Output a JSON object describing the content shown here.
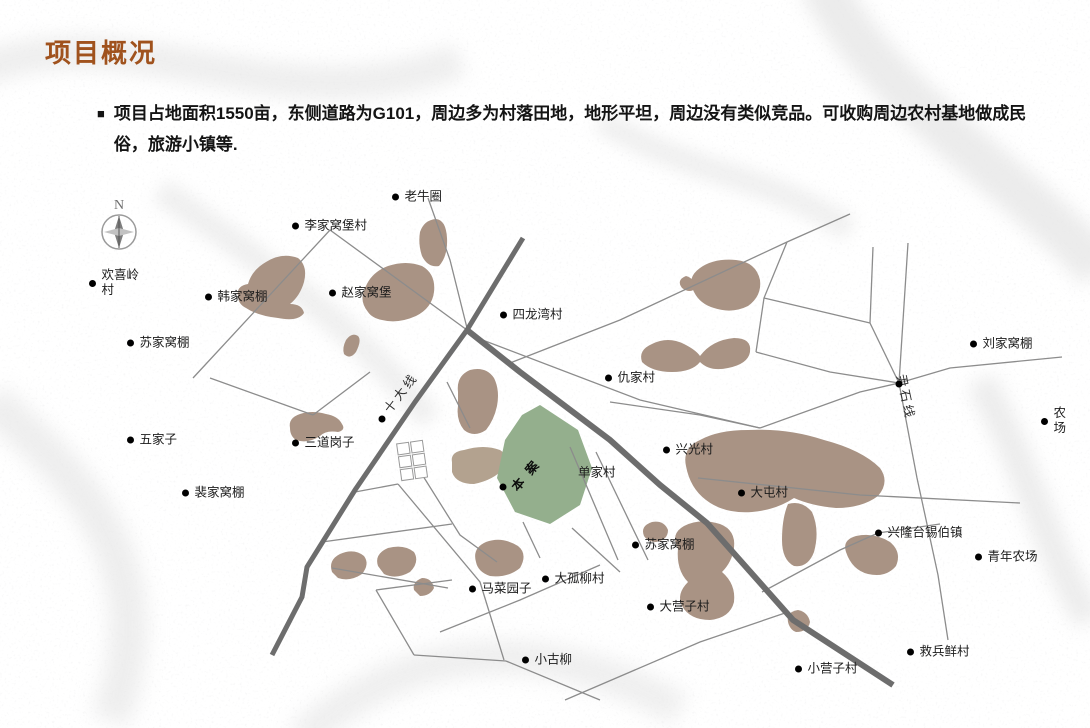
{
  "slide": {
    "title": "项目概况",
    "bullet_marker": "■",
    "bullet": "项目占地面积1550亩，东侧道路为G101，周边多为村落田地，地形平坦，周边没有类似竞品。可收购周边农村基地做成民俗，旅游小镇等."
  },
  "map": {
    "compass": {
      "label": "N",
      "x": 119,
      "y": 212
    },
    "site": {
      "label": "本案",
      "x": 527,
      "y": 472,
      "rot": -50,
      "dot_x": 503,
      "dot_y": 487
    },
    "road_labels": [
      {
        "text": "十大线",
        "x": 400,
        "y": 392,
        "rot": -52
      },
      {
        "text": "尹石线",
        "x": 907,
        "y": 397,
        "rot": 78
      }
    ],
    "villages": [
      {
        "name": "老牛圈",
        "x": 395,
        "y": 197
      },
      {
        "name": "李家窝堡村",
        "x": 295,
        "y": 226
      },
      {
        "name": "欢喜岭村",
        "x": 92,
        "y": 283,
        "w": 46
      },
      {
        "name": "韩家窝棚",
        "x": 208,
        "y": 297
      },
      {
        "name": "赵家窝堡",
        "x": 332,
        "y": 293
      },
      {
        "name": "苏家窝棚",
        "x": 130,
        "y": 343
      },
      {
        "name": "四龙湾村",
        "x": 503,
        "y": 315
      },
      {
        "name": "仇家村",
        "x": 608,
        "y": 378
      },
      {
        "name": "刘家窝棚",
        "x": 973,
        "y": 344
      },
      {
        "name": "五家子",
        "x": 130,
        "y": 440
      },
      {
        "name": "三道岗子",
        "x": 295,
        "y": 443
      },
      {
        "name": "裴家窝棚",
        "x": 185,
        "y": 493
      },
      {
        "name": "农场",
        "x": 1044,
        "y": 421,
        "w": 15
      },
      {
        "name": "兴光村",
        "x": 666,
        "y": 450
      },
      {
        "name": "单家村",
        "x": 578,
        "y": 473,
        "dot": false
      },
      {
        "name": "大屯村",
        "x": 741,
        "y": 493
      },
      {
        "name": "兴隆台锡伯镇",
        "x": 878,
        "y": 533
      },
      {
        "name": "青年农场",
        "x": 978,
        "y": 557
      },
      {
        "name": "苏家窝棚",
        "x": 635,
        "y": 545
      },
      {
        "name": "马菜园子",
        "x": 472,
        "y": 589
      },
      {
        "name": "大孤柳村",
        "x": 545,
        "y": 579
      },
      {
        "name": "大营子村",
        "x": 650,
        "y": 607
      },
      {
        "name": "小古柳",
        "x": 525,
        "y": 660
      },
      {
        "name": "小营子村",
        "x": 798,
        "y": 669
      },
      {
        "name": "救兵鲜村",
        "x": 910,
        "y": 652
      }
    ],
    "junction_dots": [
      {
        "x": 382,
        "y": 419
      },
      {
        "x": 899,
        "y": 384
      }
    ]
  },
  "colors": {
    "title_brown": "#a0521d",
    "site_green": "#94af8d",
    "village_area_brown": "#a99384",
    "light_area_tan": "#b3a28f",
    "road_thick_gray": "#6d6d6d",
    "road_thin_gray": "#8c8c8c"
  }
}
